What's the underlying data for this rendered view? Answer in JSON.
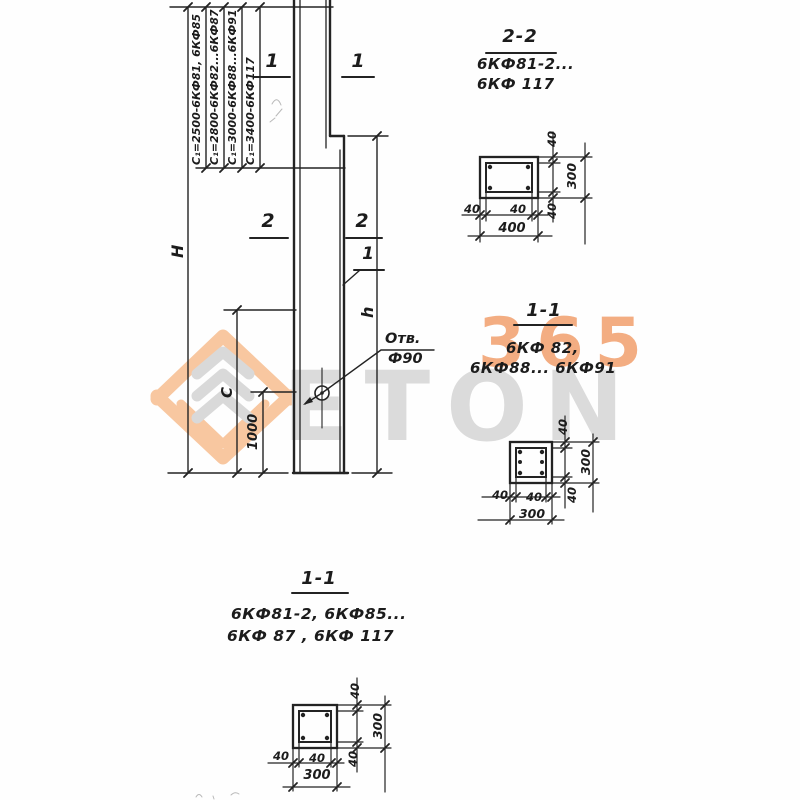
{
  "watermark": {
    "digits": "365",
    "letters": "ETON"
  },
  "colors": {
    "ink": "#202020",
    "wm_gray": "#dbdbdb",
    "wm_orange": "#f0965f",
    "wm_peach": "#f8c7a0"
  },
  "column_view": {
    "c1_labels": [
      {
        "label": "С₁=2500-6КФ81, 6КФ85"
      },
      {
        "label": "С₁=2800-6КФ82...6КФ87"
      },
      {
        "label": "С₁=3000-6КФ88...6КФ91"
      },
      {
        "label": "С₁=3400-6КФ117"
      }
    ],
    "dim_H": "Н",
    "dim_C": "С",
    "dim_1000": "1000",
    "dim_h": "h",
    "marks": {
      "top_left": "1",
      "top_right": "1",
      "mid_left": "2",
      "mid_right": "2",
      "leader": "1"
    },
    "hole": {
      "line1": "Отв.",
      "line2": "Ф90"
    }
  },
  "sections": [
    {
      "title": "2-2",
      "line1": "6КФ81-2...",
      "line2": "6КФ 117",
      "cover_top": "40",
      "height": "300",
      "cover_bottom": "40",
      "cover_left": "40",
      "cover_right": "40",
      "width": "400"
    },
    {
      "title": "1-1",
      "line1": "6КФ 82,",
      "line2": "6КФ88... 6КФ91",
      "cover_top": "40",
      "height": "300",
      "cover_bottom": "40",
      "cover_left": "40",
      "cover_right": "40",
      "width": "300"
    },
    {
      "title": "1-1",
      "line1": "6КФ81-2, 6КФ85...",
      "line2": "6КФ 87 ,  6КФ 117",
      "cover_top": "40",
      "height": "300",
      "cover_bottom": "40",
      "cover_left": "40",
      "cover_right": "40",
      "width": "300"
    }
  ]
}
